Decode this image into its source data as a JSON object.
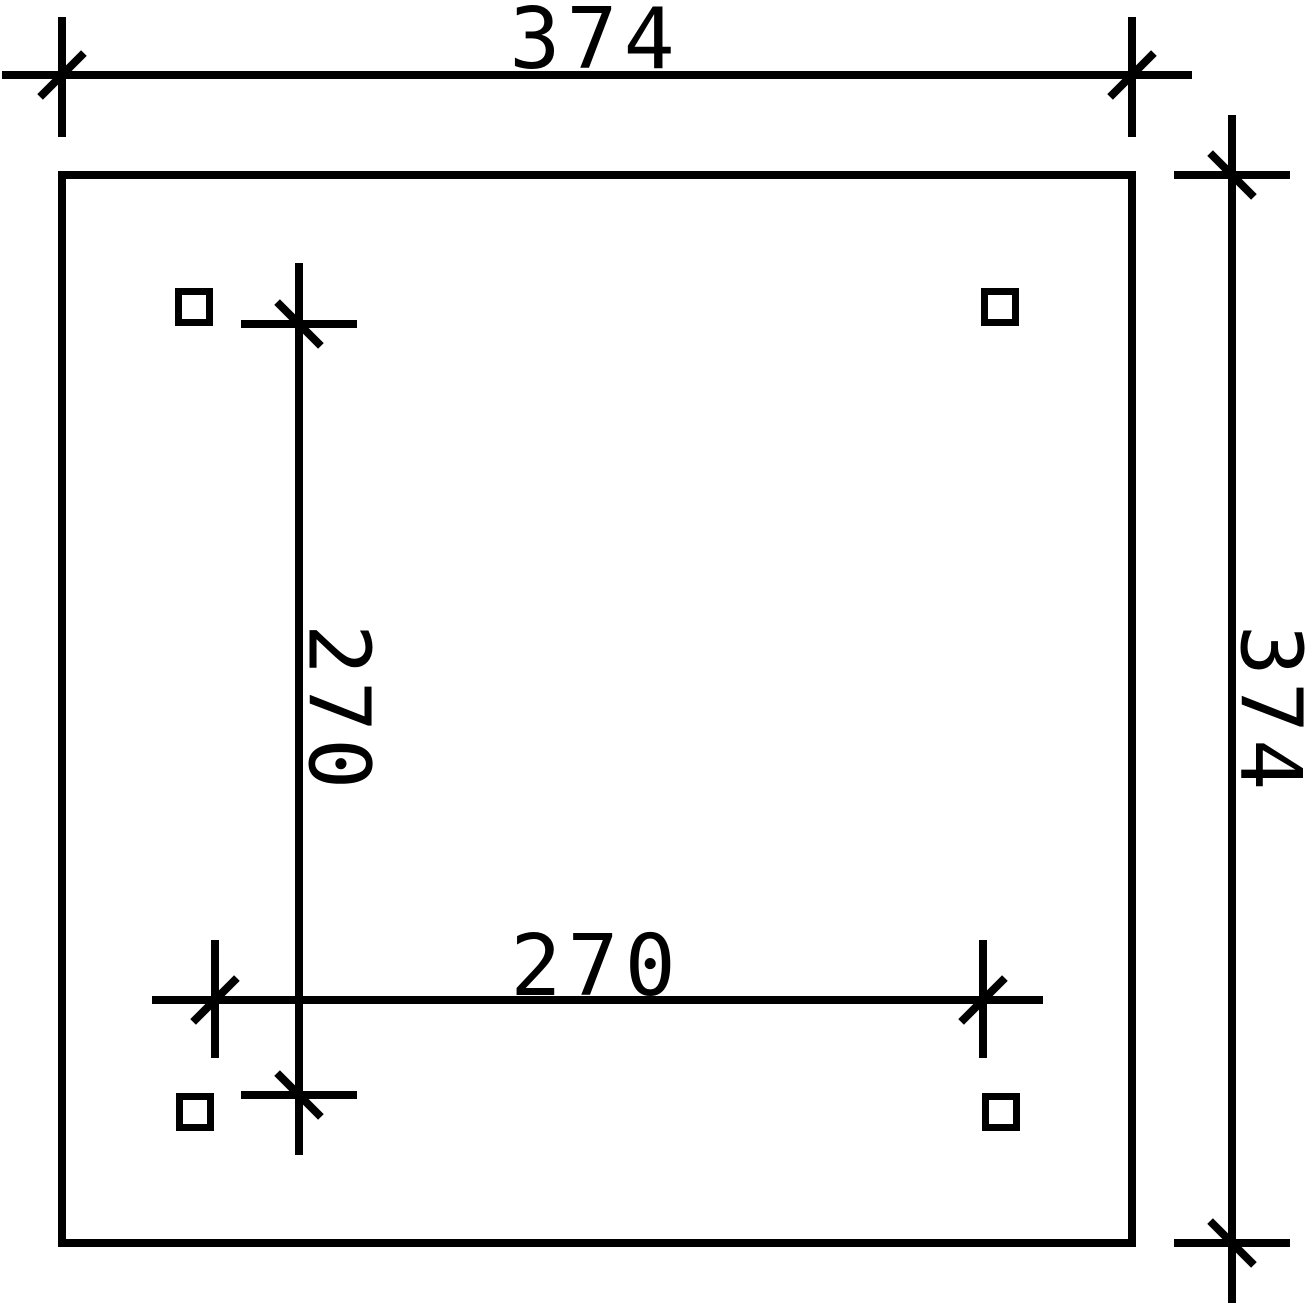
{
  "drawing": {
    "background_color": "#ffffff",
    "line_color": "#000000",
    "outline_shape": "square",
    "posts": [
      {
        "position": "top-left"
      },
      {
        "position": "top-right"
      },
      {
        "position": "bottom-left"
      },
      {
        "position": "bottom-right"
      }
    ],
    "dimensions": {
      "overall_width": {
        "label": "374",
        "orientation": "horizontal",
        "position": "top"
      },
      "overall_depth": {
        "label": "374",
        "orientation": "vertical",
        "position": "right"
      },
      "inner_depth": {
        "label": "270",
        "orientation": "vertical",
        "position": "inner-left"
      },
      "inner_width": {
        "label": "270",
        "orientation": "horizontal",
        "position": "inner-bottom"
      }
    }
  }
}
